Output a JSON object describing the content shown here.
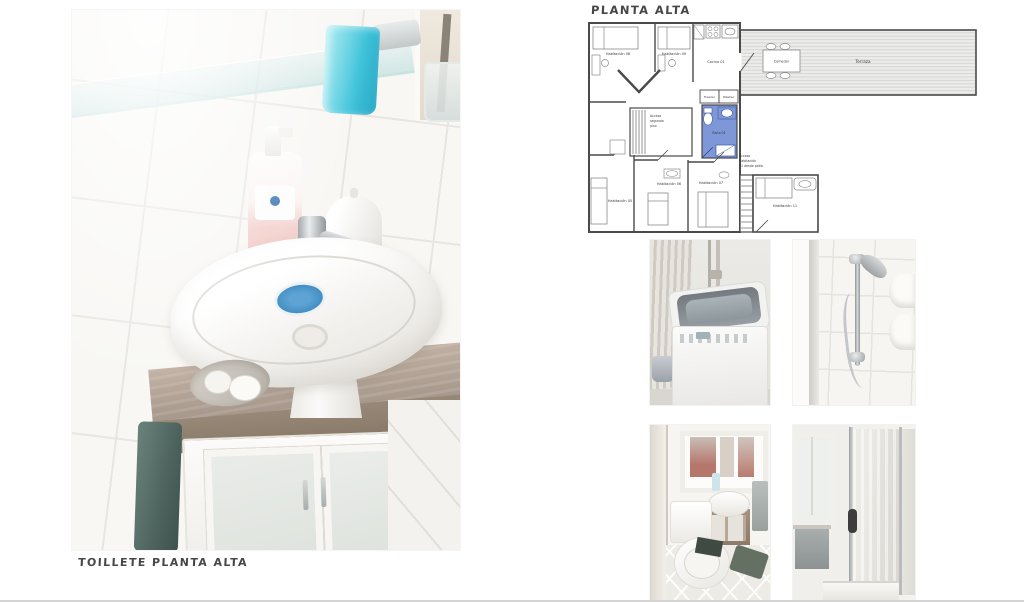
{
  "title_block": {
    "plan_title": "PLANTA ALTA"
  },
  "captions": {
    "main_photo": "TOILLETE PLANTA ALTA"
  },
  "floorplan": {
    "rooms": {
      "hab08": "Habitación 08",
      "hab09": "Habitación 09",
      "cocina": "Cocina 01",
      "comedor": "Comedor",
      "terraza": "Terraza",
      "freezer": "Freezer",
      "washer": "Washer",
      "bano": "Baño 04",
      "hab05": "Habitación 05",
      "hab06": "Habitación 06",
      "hab07": "Habitación 07",
      "hab11": "Habitación 11"
    },
    "annotations": {
      "acceso_segundo_l1": "Acceso",
      "acceso_segundo_l2": "segundo",
      "acceso_segundo_l3": "piso",
      "acceso_hab11_l1": "Acceso",
      "acceso_hab11_l2": "Habitación",
      "acceso_hab11_l3": "11 desde patio"
    },
    "colors": {
      "bathroom_highlight": "#7d97d8",
      "wall": "#4a4a4a"
    }
  },
  "photos": {
    "main": "bathroom-sink-with-wood-counter-and-cabinet",
    "thumb1": "washing-machine",
    "thumb2": "shower-handset-on-tiled-wall",
    "thumb3": "small-toilet-room",
    "thumb4": "shower-glass-door"
  }
}
